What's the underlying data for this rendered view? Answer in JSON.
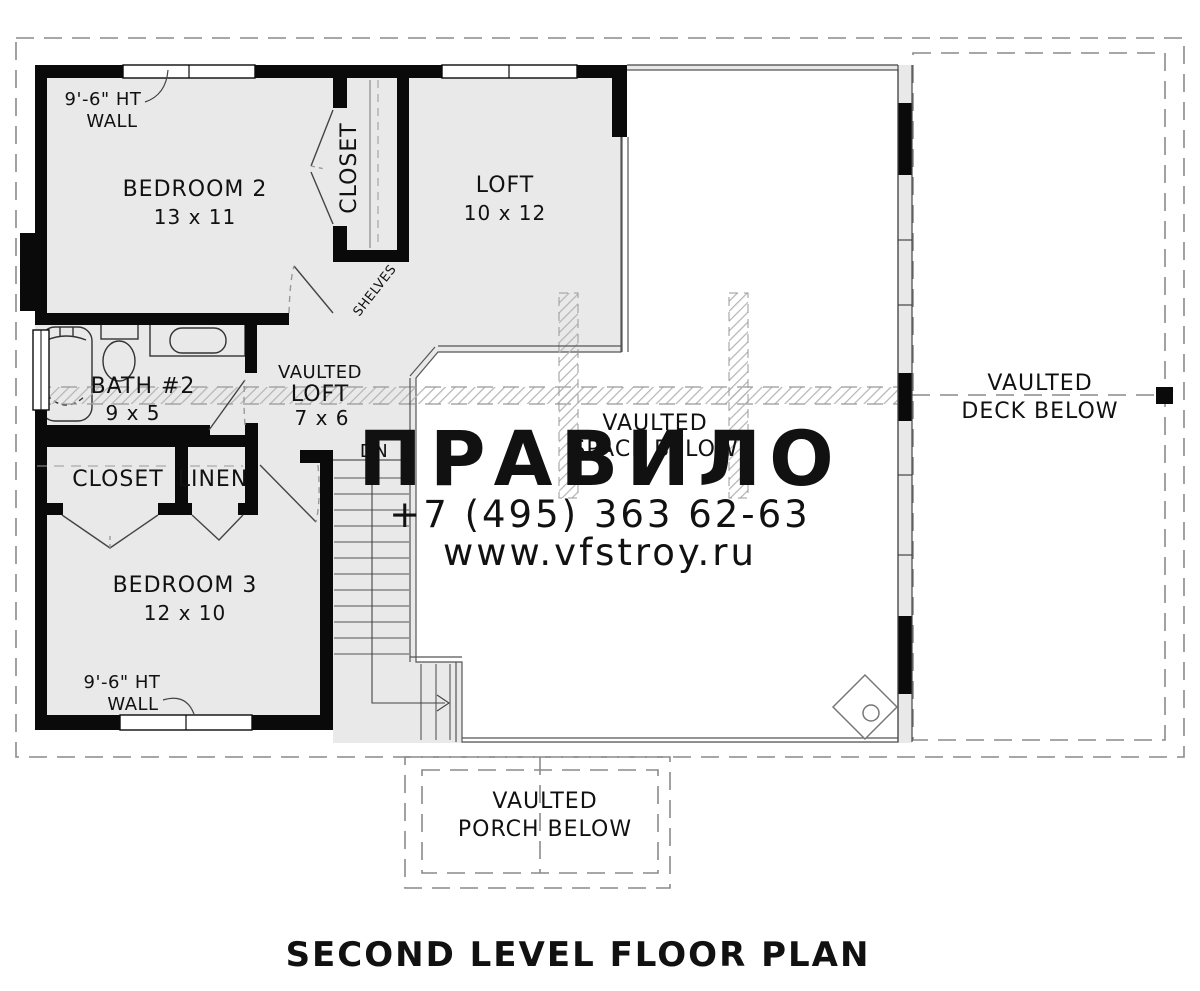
{
  "title": "SECOND LEVEL FLOOR PLAN",
  "watermark": {
    "brand": "ПРАВИЛО",
    "phone": "+7 (495) 363 62-63",
    "site": "www.vfstroy.ru"
  },
  "rooms": {
    "bedroom2": {
      "name": "BEDROOM 2",
      "dims": "13 x 11"
    },
    "closet2": {
      "name": "CLOSET"
    },
    "loft": {
      "name": "LOFT",
      "dims": "10 x 12"
    },
    "bath2": {
      "name": "BATH #2",
      "dims": "9 x 5"
    },
    "vaulted_loft": {
      "line1": "VAULTED",
      "line2": "LOFT",
      "dims": "7 x 6"
    },
    "closet3": {
      "name": "CLOSET"
    },
    "linen": {
      "name": "LINEN"
    },
    "bedroom3": {
      "name": "BEDROOM 3",
      "dims": "12 x 10"
    },
    "vaulted_space": {
      "line1": "VAULTED",
      "line2": "SPACE BELOW"
    },
    "vaulted_deck": {
      "line1": "VAULTED",
      "line2": "DECK BELOW"
    },
    "vaulted_porch": {
      "line1": "VAULTED",
      "line2": "PORCH BELOW"
    }
  },
  "annotations": {
    "wall_height_top": {
      "line1": "9'-6\" HT",
      "line2": "WALL"
    },
    "wall_height_bottom": {
      "line1": "9'-6\" HT",
      "line2": "WALL"
    },
    "shelves": "SHELVES",
    "stairs_down": "DN"
  },
  "colors": {
    "wall": "#0a0a0a",
    "room_fill": "#e9e9e9",
    "thin_line": "#4a4a4a",
    "dashed_line": "#8a8a8a",
    "hatch": "#b4b4b4",
    "watermark": "#c7c7c7"
  }
}
